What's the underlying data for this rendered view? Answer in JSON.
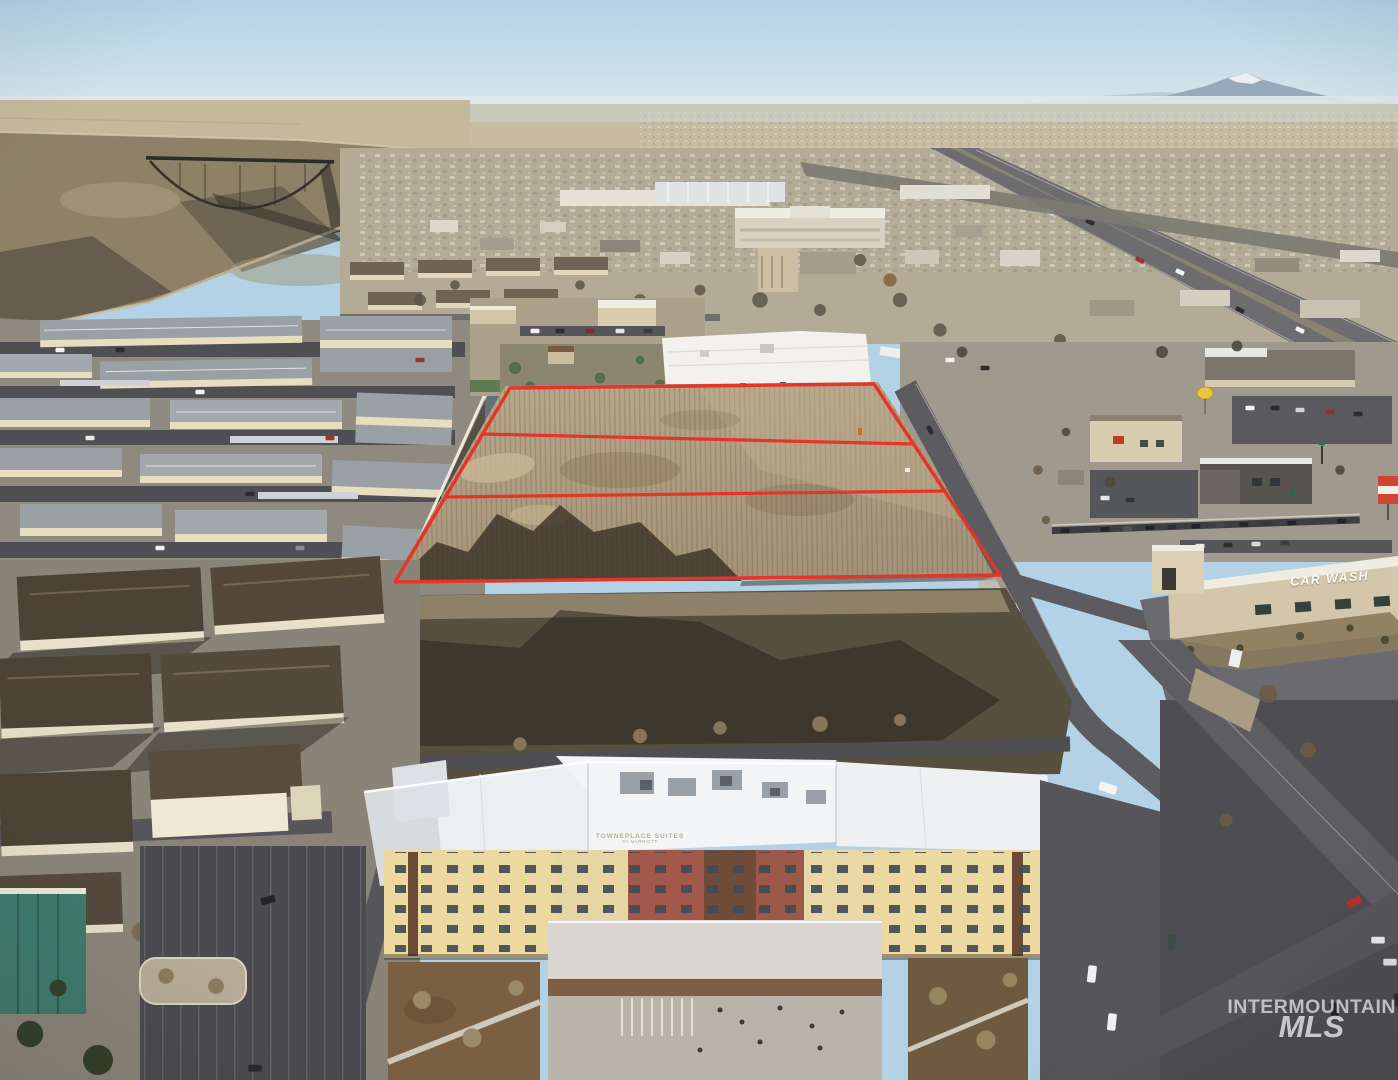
{
  "watermark": {
    "line1": "INTERMOUNTAIN",
    "line2": "MLS"
  },
  "signs": {
    "car_wash": "CAR WASH",
    "hotel": "TOWNEPLACE SUITES",
    "hotel_sub": "BY MARRIOTT"
  },
  "parcel": {
    "outline_color": "#e63429",
    "lot_count": 3
  },
  "palette": {
    "sky": "#b3d2e6",
    "field_dirt": "#b2a083",
    "asphalt": "#4e4e52",
    "white_roof": "#f2f1ee",
    "shadow": "#57503f",
    "red_outline": "#e63429"
  }
}
